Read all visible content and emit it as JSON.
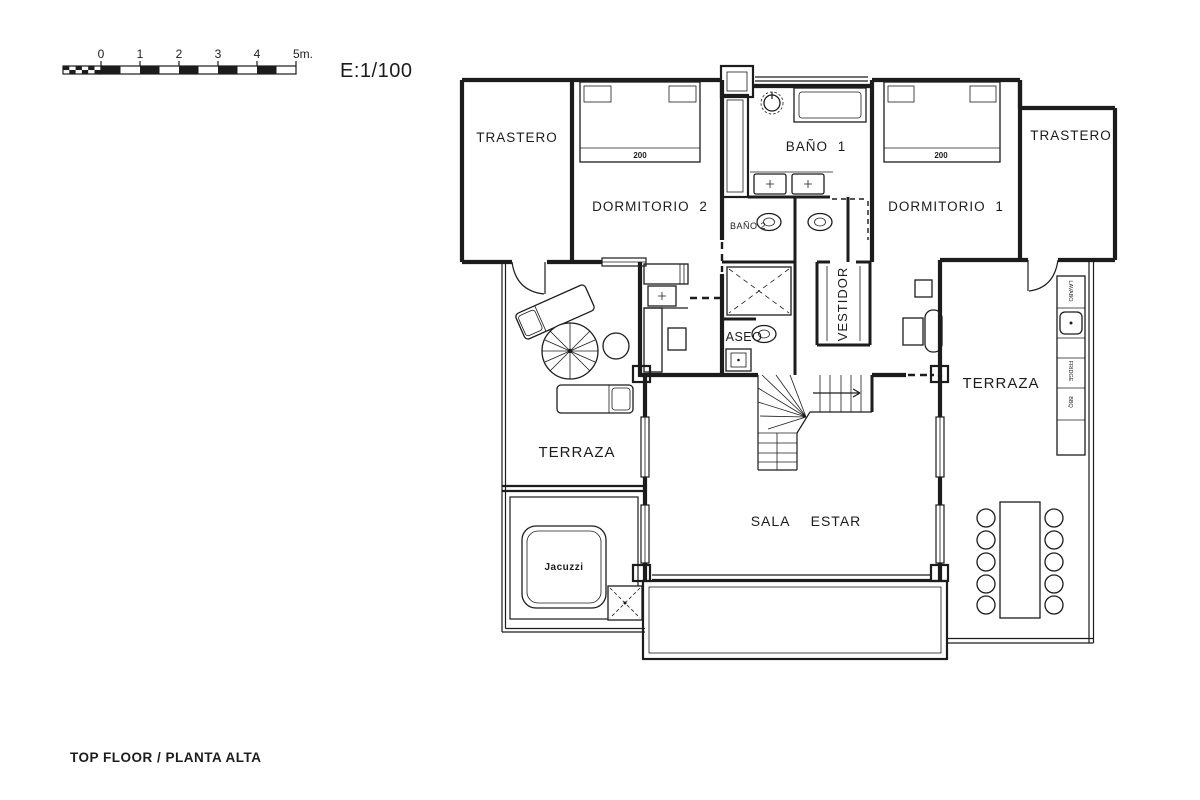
{
  "scale_bar": {
    "ticks": [
      "0",
      "1",
      "2",
      "3",
      "4",
      "5m."
    ],
    "ratio": "E:1/100"
  },
  "title": {
    "floor": "TOP FLOOR / PLANTA ALTA"
  },
  "rooms": {
    "trastero_left": "TRASTERO",
    "dormitorio_2": "DORMITORIO 2",
    "bano_1": "BAÑO 1",
    "bano_2": "BAÑO 2",
    "aseo": "ASEO",
    "vestidor": "VESTIDOR",
    "dormitorio_1": "DORMITORIO 1",
    "trastero_right": "TRASTERO",
    "terraza_left": "TERRAZA",
    "terraza_right": "TERRAZA",
    "sala_estar": "SALA ESTAR"
  },
  "fixtures": {
    "jacuzzi": "Jacuzzi",
    "bed1_size": "200",
    "bed2_size": "200",
    "outdoor_sink": "LAVABO",
    "fridge": "FRIDGE",
    "bbq": "BBQ"
  },
  "colors": {
    "line": "#1c1c1c",
    "background": "#ffffff"
  }
}
